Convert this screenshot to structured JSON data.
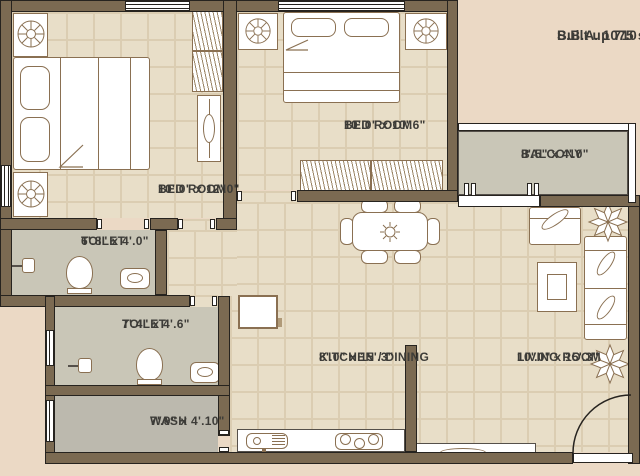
{
  "summary": {
    "built_up": "Built up 710 sq.ft.",
    "sba": "S.B.A. 1075 sq.ft."
  },
  "rooms": {
    "bedroom1": {
      "name": "BED ROOM",
      "dims": "10'.0\" x 12'.0\""
    },
    "bedroom2": {
      "name": "BED ROOM",
      "dims": "10'.0\" x 10'.6\""
    },
    "balcony": {
      "name": "BALCONY",
      "dims": "8'.5\" x 4'.0\""
    },
    "toilet1": {
      "name": "TOILET",
      "dims": "6'.8\" x 4'.0\""
    },
    "toilet2": {
      "name": "TOILET",
      "dims": "7'.4\" x 4'.6\""
    },
    "wash": {
      "name": "WASH",
      "dims": "7'.9\" x 4'.10\""
    },
    "kitchen_dining": {
      "name": "KITCHEN / DINING",
      "dims": "8'.0\" x 15'.3\""
    },
    "living_room": {
      "name": "LIVING ROOM",
      "dims": "10'.0\" x 15'.3\""
    }
  },
  "colors": {
    "background": "#ebd9c5",
    "wall": "#7b6a52",
    "wall_outline": "#26231f",
    "tile_floor": "#e8dec8",
    "tile_grid": "#dbcdb2",
    "gray_floor": "#c9c6b7",
    "wash_floor": "#bcb9ae",
    "furniture_line": "#8a7052",
    "text": "#3d3c38"
  }
}
